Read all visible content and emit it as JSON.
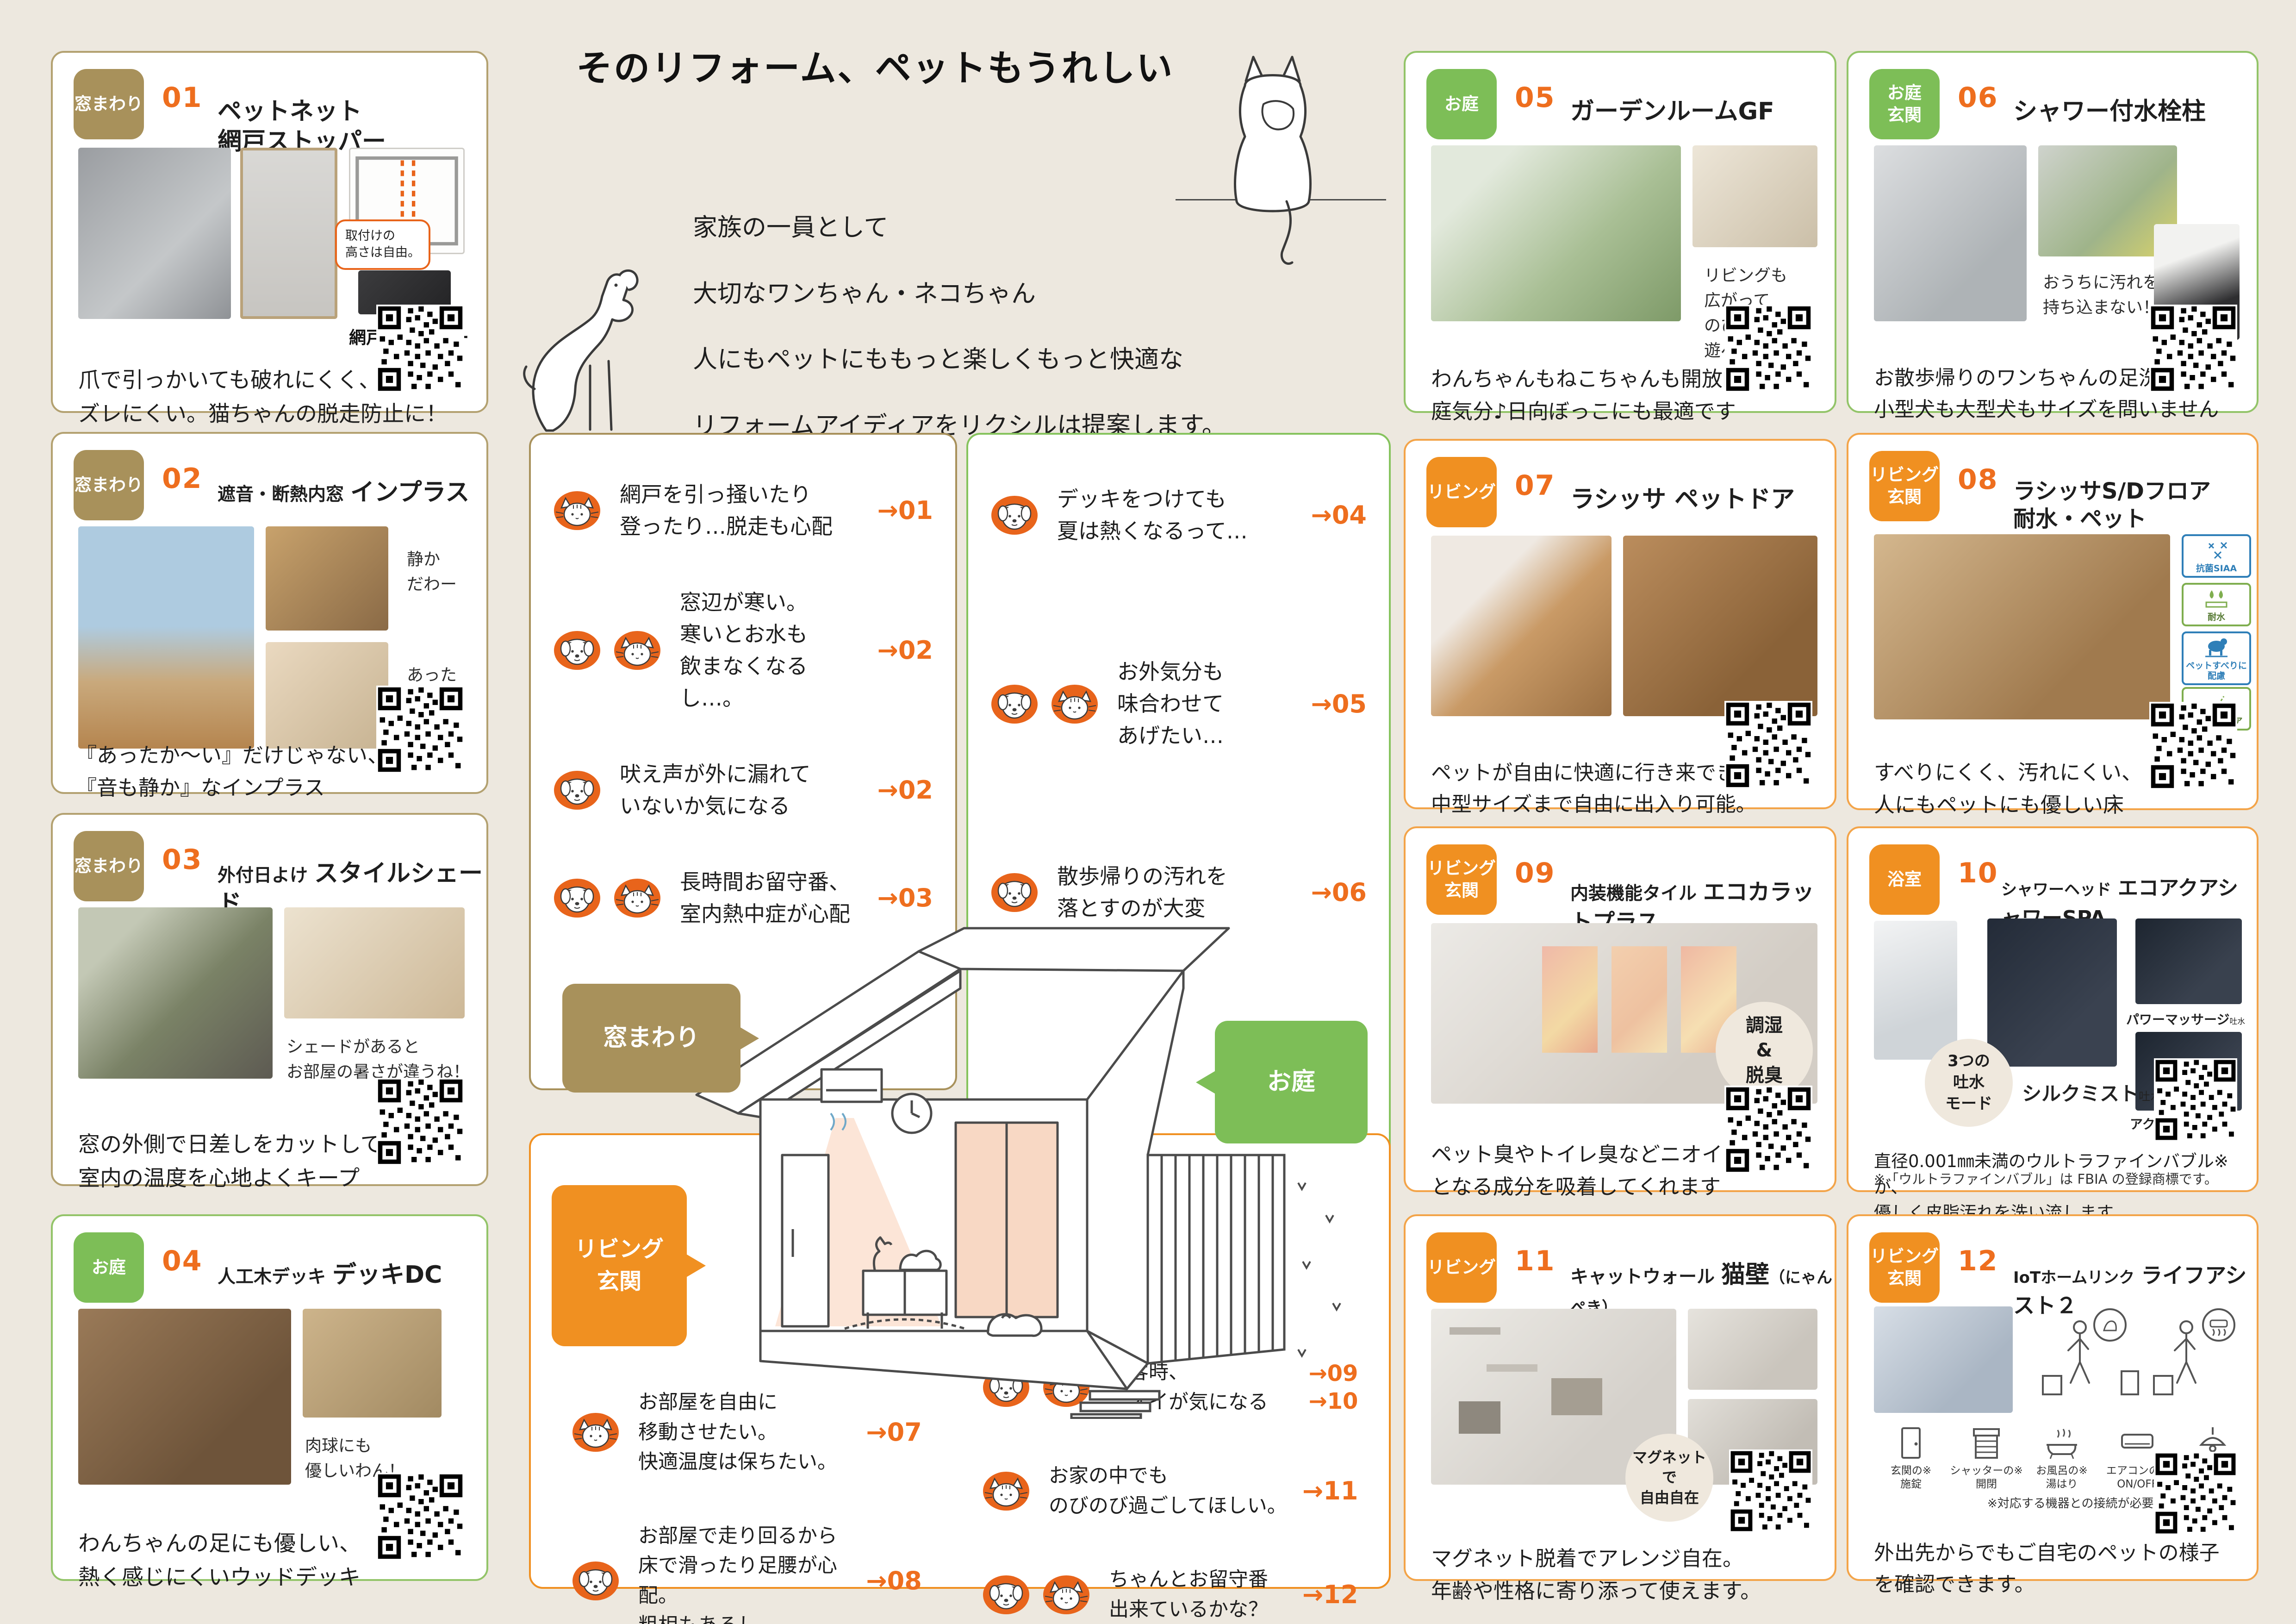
{
  "page": {
    "title": "そのリフォーム、ペットもうれしい",
    "intro1": "家族の一員として\n大切なワンちゃん・ネコちゃん",
    "intro2": "人にもペットにももっと楽しくもっと快適な\nリフォームアイディアをリクシルは提案します。",
    "accent_orange": "#F09021",
    "accent_green": "#7DBE57",
    "accent_olive": "#A8915B",
    "number_orange": "#EE6E1E",
    "background": "#EDE8DF"
  },
  "panels": {
    "windows": {
      "bubble": "窓まわり",
      "items": [
        {
          "icons": [
            "cat"
          ],
          "text": "網戸を引っ掻いたり\n登ったり…脱走も心配",
          "arrow": "→01"
        },
        {
          "icons": [
            "dog",
            "cat"
          ],
          "text": "窓辺が寒い。\n寒いとお水も\n飲まなくなるし…。",
          "arrow": "→02"
        },
        {
          "icons": [
            "dog"
          ],
          "text": "吠え声が外に漏れて\nいないか気になる",
          "arrow": "→02"
        },
        {
          "icons": [
            "dog",
            "cat"
          ],
          "text": "長時間お留守番、\n室内熱中症が心配",
          "arrow": "→03"
        }
      ]
    },
    "garden": {
      "bubble": "お庭",
      "items": [
        {
          "icons": [
            "dog"
          ],
          "text": "デッキをつけても\n夏は熱くなるって…",
          "arrow": "→04"
        },
        {
          "icons": [
            "dog",
            "cat"
          ],
          "text": "お外気分も\n味合わせて\nあげたい…",
          "arrow": "→05"
        },
        {
          "icons": [
            "dog"
          ],
          "text": "散歩帰りの汚れを\n落とすのが大変",
          "arrow": "→06"
        }
      ]
    },
    "living": {
      "bubble": "リビング\n玄関",
      "left_items": [
        {
          "icons": [
            "cat"
          ],
          "text": "お部屋を自由に\n移動させたい。\n快適温度は保ちたい。",
          "arrow": "→07"
        },
        {
          "icons": [
            "dog"
          ],
          "text": "お部屋で走り回るから\n床で滑ったり足腰が心配。\n粗相もあるし…",
          "arrow": "→08"
        }
      ],
      "right_items": [
        {
          "icons": [
            "dog",
            "cat"
          ],
          "text": "来客時、\nニオイが気になる",
          "arrow": "→09\n→10"
        },
        {
          "icons": [
            "cat"
          ],
          "text": "お家の中でも\nのびのび過ごしてほしい。",
          "arrow": "→11"
        },
        {
          "icons": [
            "dog",
            "cat"
          ],
          "text": "ちゃんとお留守番\n出来ているかな？",
          "arrow": "→12"
        }
      ]
    }
  },
  "cards": [
    {
      "badge": "窓まわり",
      "num": "01",
      "title": "ペットネット\n網戸ストッパー",
      "callout": "取付けの\n高さは自由。",
      "product_label": "網戸ストッパー",
      "caption": "爪で引っかいても破れにくく、\nズレにくい。猫ちゃんの脱走防止に！"
    },
    {
      "badge": "窓まわり",
      "num": "02",
      "prefix": "遮音・断熱内窓",
      "title": "インプラス",
      "note1": "静か\nだわー",
      "note2": "あった\nかーい",
      "caption": "『あったか〜い』だけじゃない、\n『音も静か』なインプラス"
    },
    {
      "badge": "窓まわり",
      "num": "03",
      "prefix": "外付日よけ",
      "title": "スタイルシェード",
      "annotation": "シェードがあると\nお部屋の暑さが違うね！",
      "caption": "窓の外側で日差しをカットして、\n室内の温度を心地よくキープ"
    },
    {
      "badge": "お庭",
      "num": "04",
      "prefix": "人工木デッキ",
      "title": "デッキDC",
      "annotation": "肉球にも\n優しいわん！",
      "caption": "わんちゃんの足にも優しい、\n熱く感じにくいウッドデッキ"
    },
    {
      "badge": "お庭",
      "num": "05",
      "title": "ガーデンルームGF",
      "annotation": "リビングも\n広がって\nのびのび\n遊べます。",
      "caption": "わんちゃんもねこちゃんも開放的にお\n庭気分♪日向ぼっこにも最適です"
    },
    {
      "badge": "お庭\n玄関",
      "num": "06",
      "title": "シャワー付水栓柱",
      "annotation": "おうちに汚れを\n持ち込まない！",
      "caption": "お散歩帰りのワンちゃんの足洗いに\n小型犬も大型犬もサイズを問いません"
    },
    {
      "badge": "リビング",
      "num": "07",
      "title": "ラシッサ ペットドア",
      "caption": "ペットが自由に快適に行き来できます。\n中型サイズまで自由に出入り可能。"
    },
    {
      "badge": "リビング\n玄関",
      "num": "08",
      "title": "ラシッサS/Dフロア\n耐水・ペット",
      "cert1": "抗菌SIAA",
      "cert2": "耐水",
      "cert3": "ペットすべりに\n配慮",
      "cert4": "耐アンモニア",
      "caption": "すべりにくく、汚れにくい、\n人にもペットにも優しい床"
    },
    {
      "badge": "リビング\n玄関",
      "num": "09",
      "prefix": "内装機能タイル",
      "title": "エコカラットプラス",
      "circle_badge": "調湿\n&\n脱臭",
      "caption": "ペット臭やトイレ臭などニオイの原因\nとなる成分を吸着してくれます"
    },
    {
      "badge": "浴室",
      "num": "10",
      "prefix": "シャワーヘッド",
      "title": "エコアクアシャワーSPA",
      "circle_badge": "3つの\n吐水\nモード",
      "mode1": "シルクミスト",
      "mode1_suffix": "吐水",
      "mode2": "パワーマッサージ",
      "mode2_suffix": "吐水",
      "mode3": "アクアスプレー",
      "mode3_suffix": "吐水",
      "caption": "直径0.001㎜未満のウルトラファインバブル※が、\n優しく皮脂汚れを洗い流します",
      "note": "※「ウルトラファインバブル」は FBIA の登録商標です。"
    },
    {
      "badge": "リビング",
      "num": "11",
      "prefix": "キャットウォール",
      "title": "猫壁",
      "suffix": "（にゃんぺき）",
      "circle_badge": "マグネット\nで\n自由自在",
      "caption": "マグネット脱着でアレンジ自在。\n年齢や性格に寄り添って使えます。"
    },
    {
      "badge": "リビング\n玄関",
      "num": "12",
      "prefix": "IoTホームリンク",
      "title": "ライフアシスト２",
      "iot1": "玄関の※\n施錠",
      "iot2": "シャッターの※\n開閉",
      "iot3": "お風呂の※\n湯はり",
      "iot4": "エアコンの※\nON/OFF",
      "iot5": "照明の※\nON/OFF",
      "note": "※対応する機器との接続が必要となります。",
      "caption": "外出先からでもご自宅のペットの様子\nを確認できます。"
    }
  ]
}
